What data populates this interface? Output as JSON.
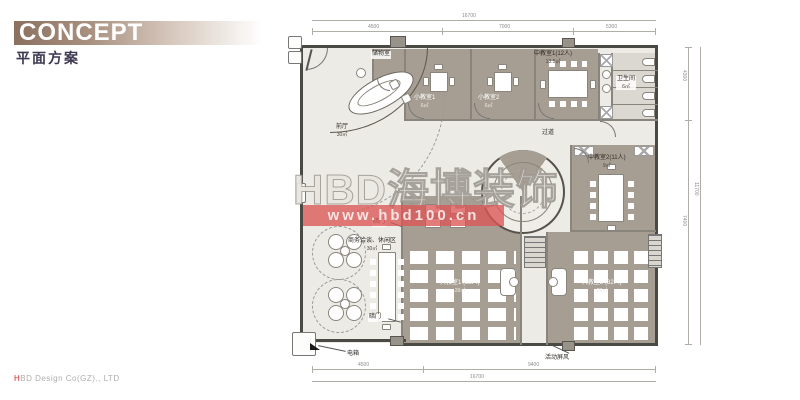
{
  "header": {
    "title": "CONCEPT",
    "subtitle": "平面方案"
  },
  "footer": {
    "company_prefix": "H",
    "company_rest": "BD Design Co(GZ)., LTD"
  },
  "watermark": {
    "logo": "HBD海博装饰",
    "url": "www.hbd100.cn",
    "band_color": "#db5656"
  },
  "rooms": {
    "front_hall": {
      "name": "前厅",
      "area": "30㎡"
    },
    "storage": {
      "name": "储物室"
    },
    "small1": {
      "name": "小教室1",
      "area": "6㎡"
    },
    "small2": {
      "name": "小教室2",
      "area": "6㎡"
    },
    "medium1": {
      "name": "中教室1(12人)",
      "area": "13.5㎡"
    },
    "washroom": {
      "name": "卫生间",
      "area": "6㎡"
    },
    "corridor": {
      "name": "过道"
    },
    "medium2": {
      "name": "中教室2(11人)",
      "area": "9㎡"
    },
    "lounge": {
      "name": "商务洽谈、休闲区",
      "area": "30㎡"
    },
    "big1": {
      "name": "大教室1 (32人)",
      "area": "28㎡"
    },
    "big2": {
      "name": "大教室2 (32人)",
      "area": "28㎡"
    }
  },
  "annotations": {
    "hidden_door_top": "暗门",
    "hidden_door_bottom": "暗门",
    "electric_box": "电箱",
    "movable_screen": "活动屏风"
  },
  "dimensions": {
    "top_overall": "16700",
    "top_seg_1": "4500",
    "top_seg_2": "7000",
    "top_seg_3": "5300",
    "bottom_seg_1": "4500",
    "bottom_seg_2": "9400",
    "bottom_overall": "16700",
    "right_seg_1": "4300",
    "right_seg_2": "7400",
    "right_overall": "11700"
  }
}
